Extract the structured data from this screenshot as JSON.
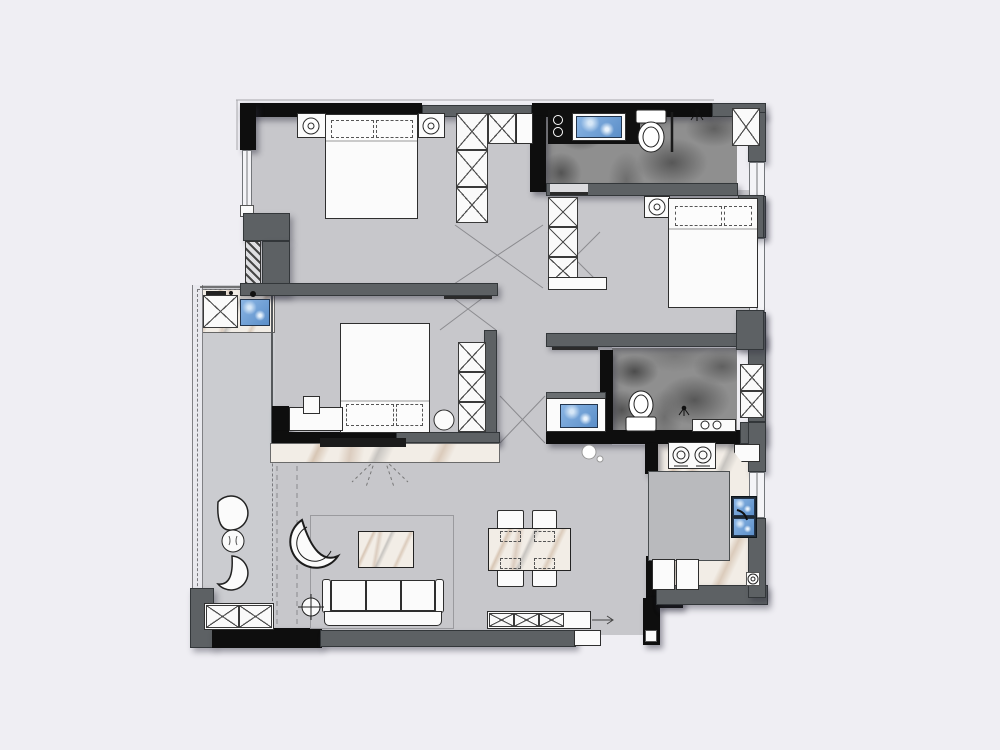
{
  "document": {
    "title": "Furnished apartment floor plan (top-down interior design drawing, no text labels)",
    "type": "floor-plan"
  },
  "palette": {
    "page_background": "#efeef3",
    "floor_gray": "#c7c7cb",
    "balcony_floor": "#cbccd0",
    "wall_black": "#0e0e0e",
    "wall_gray": "#5d6164",
    "furniture_white": "#fbfbfb",
    "marble_light": "#f2ede6",
    "marble_dark_bathroom": "#8f8f8f",
    "water_blue": "#6f9fd6",
    "line_dark": "#3a3a3a"
  },
  "rooms": [
    {
      "name": "master-bedroom",
      "position": "top-left",
      "furniture": [
        "double-bed",
        "two-dashed-pillows",
        "nightstand-left",
        "nightstand-right",
        "table-lamps",
        "l-shaped-wardrobe",
        "left-window",
        "sliding-door"
      ]
    },
    {
      "name": "bathroom-1",
      "position": "top-right",
      "furniture": [
        "black-vanity-counter",
        "blue-basin",
        "toilet",
        "glass-shower-divider",
        "shower-head-symbol",
        "duct-shaft-x",
        "dark-marble-floor"
      ]
    },
    {
      "name": "bedroom-2",
      "position": "middle-left",
      "furniture": [
        "double-bed-vertical",
        "dashed-pillows",
        "wardrobe-3-cell",
        "desk",
        "desk-chair",
        "round-stool",
        "tv-wall"
      ]
    },
    {
      "name": "bedroom-3",
      "position": "middle-right",
      "furniture": [
        "double-bed",
        "dashed-pillows",
        "nightstand",
        "table-lamp",
        "wardrobe-3-cell",
        "right-window"
      ]
    },
    {
      "name": "bathroom-2",
      "position": "center-right",
      "furniture": [
        "vanity-with-blue-basin",
        "toilet",
        "shower-drain",
        "ledge-with-outlets",
        "duct-shaft",
        "dark-marble-floor"
      ]
    },
    {
      "name": "kitchen",
      "position": "bottom-right",
      "furniture": [
        "two-burner-stove",
        "island-counter",
        "double-blue-sink",
        "base-cabinets",
        "corner-shelf",
        "floor-drain",
        "light-marble-floor",
        "window"
      ]
    },
    {
      "name": "living-dining-room",
      "position": "bottom-center",
      "furniture": [
        "three-seat-sofa",
        "coffee-table-marble",
        "corner-lounge-chair",
        "floor-lamp",
        "tv-console-marble",
        "tv",
        "rug-outline",
        "dining-table-marble",
        "four-dining-chairs",
        "sideboard-x-cells",
        "pendant-light",
        "curtain-dashed-tracks"
      ]
    },
    {
      "name": "balcony",
      "position": "left-strip",
      "furniture": [
        "washing-machine-x",
        "laundry-blue-sink",
        "two-fan-chairs",
        "round-side-table",
        "storage-cabinet-x",
        "glass-window-line"
      ]
    },
    {
      "name": "entry",
      "position": "bottom-right-corner",
      "furniture": [
        "door-sill",
        "black-l-wall"
      ]
    }
  ]
}
